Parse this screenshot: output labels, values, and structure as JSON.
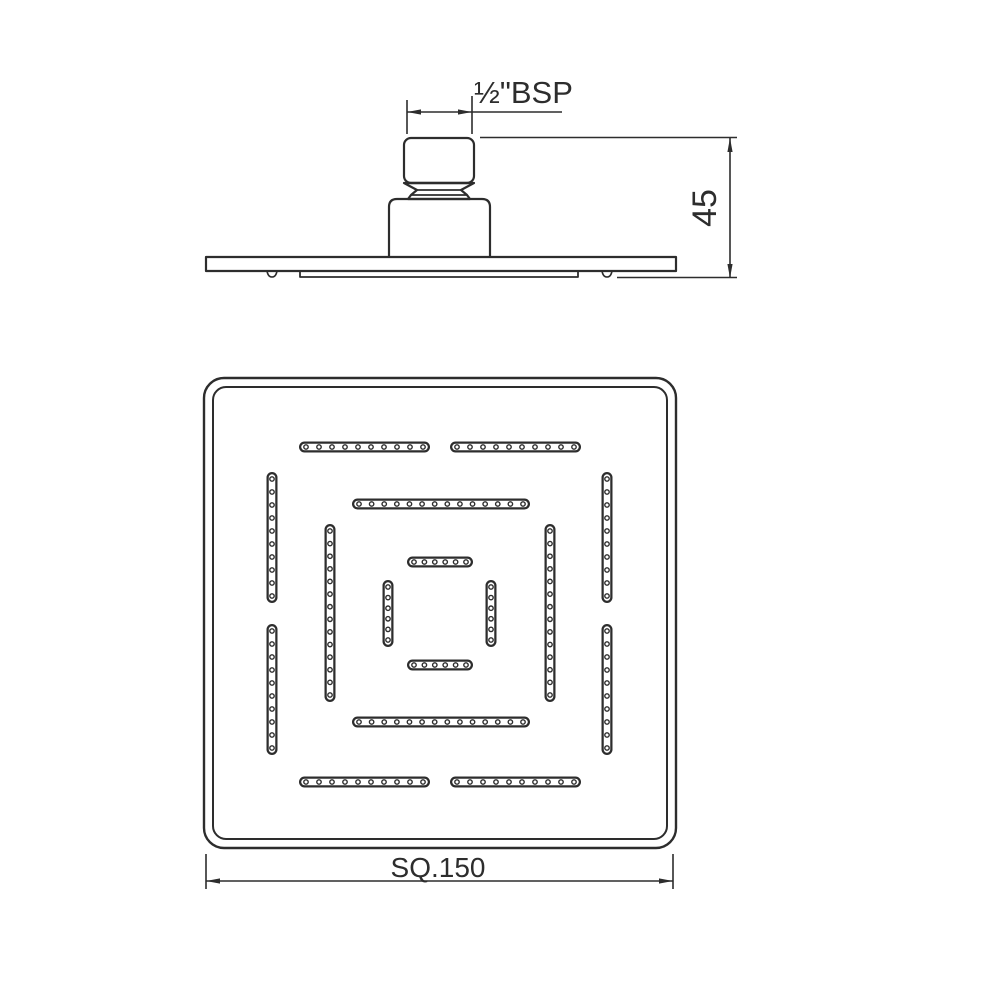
{
  "drawing": {
    "type": "technical-drawing-shower-head",
    "background": "#ffffff",
    "line_color": "#2d2d2d"
  },
  "side_view": {
    "thread_label": "½\"BSP",
    "height_label": "45"
  },
  "plan_view": {
    "size_label": "SQ.150",
    "nozzle_strips": [
      {
        "o": "h",
        "x1": 299,
        "x2": 430,
        "y": 447,
        "holes": 10
      },
      {
        "o": "h",
        "x1": 450,
        "x2": 581,
        "y": 447,
        "holes": 10
      },
      {
        "o": "h",
        "x1": 352,
        "x2": 530,
        "y": 504,
        "holes": 14
      },
      {
        "o": "h",
        "x1": 407,
        "x2": 473,
        "y": 562,
        "holes": 6
      },
      {
        "o": "h",
        "x1": 407,
        "x2": 473,
        "y": 665,
        "holes": 6
      },
      {
        "o": "h",
        "x1": 352,
        "x2": 530,
        "y": 722,
        "holes": 14
      },
      {
        "o": "h",
        "x1": 299,
        "x2": 430,
        "y": 782,
        "holes": 10
      },
      {
        "o": "h",
        "x1": 450,
        "x2": 581,
        "y": 782,
        "holes": 10
      },
      {
        "o": "v",
        "y1": 472,
        "y2": 603,
        "x": 272,
        "holes": 10
      },
      {
        "o": "v",
        "y1": 624,
        "y2": 755,
        "x": 272,
        "holes": 10
      },
      {
        "o": "v",
        "y1": 524,
        "y2": 702,
        "x": 330,
        "holes": 14
      },
      {
        "o": "v",
        "y1": 580,
        "y2": 647,
        "x": 388,
        "holes": 6
      },
      {
        "o": "v",
        "y1": 580,
        "y2": 647,
        "x": 491,
        "holes": 6
      },
      {
        "o": "v",
        "y1": 524,
        "y2": 702,
        "x": 550,
        "holes": 14
      },
      {
        "o": "v",
        "y1": 472,
        "y2": 603,
        "x": 607,
        "holes": 10
      },
      {
        "o": "v",
        "y1": 624,
        "y2": 755,
        "x": 607,
        "holes": 10
      }
    ]
  }
}
